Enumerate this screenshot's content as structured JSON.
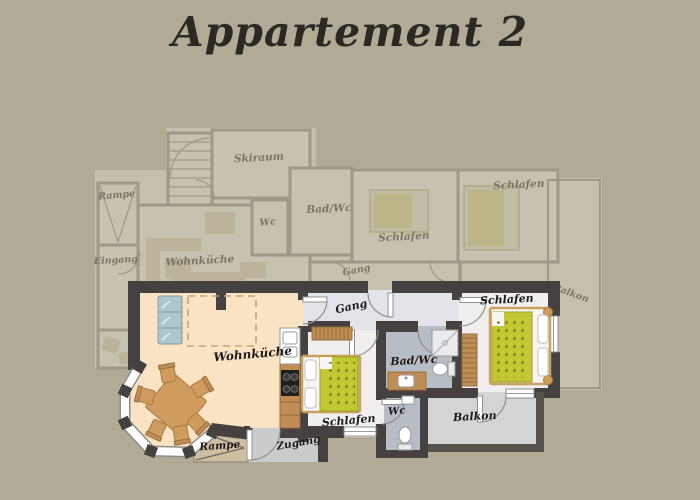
{
  "title": "Appartement 2",
  "colors": {
    "canvas": "#b1ab96",
    "wall": "#454140",
    "wohnkueche_floor": "#f9e3c3",
    "bedroom_floor": "#f1efee",
    "gang_floor": "#e4e3ea",
    "bad_floor": "#b7bdc5",
    "balkon_floor": "#d4d4d4",
    "bed_duvet": "#c2c832",
    "furniture_wood": "#cf9c5d",
    "sofa": "#aec6cd",
    "title_text": "#2c2925"
  },
  "foreground_plan": {
    "name": "Appartement 2 floor plan",
    "rooms": [
      {
        "label": "Wohnküche"
      },
      {
        "label": "Schlafen"
      },
      {
        "label": "Gang"
      },
      {
        "label": "Bad/Wc"
      },
      {
        "label": "Wc"
      },
      {
        "label": "Schlafen"
      },
      {
        "label": "Balkon"
      },
      {
        "label": "Rampe"
      },
      {
        "label": "Zugang"
      }
    ]
  },
  "background_plan": {
    "name": "adjacent apartment (faded)",
    "rooms": [
      {
        "label": "Skiraum"
      },
      {
        "label": "Rampe"
      },
      {
        "label": "Eingang"
      },
      {
        "label": "Wohnküche"
      },
      {
        "label": "Wc"
      },
      {
        "label": "Bad/Wc"
      },
      {
        "label": "Schlafen"
      },
      {
        "label": "Schlafen"
      },
      {
        "label": "Gang"
      },
      {
        "label": "Balkon"
      }
    ]
  }
}
